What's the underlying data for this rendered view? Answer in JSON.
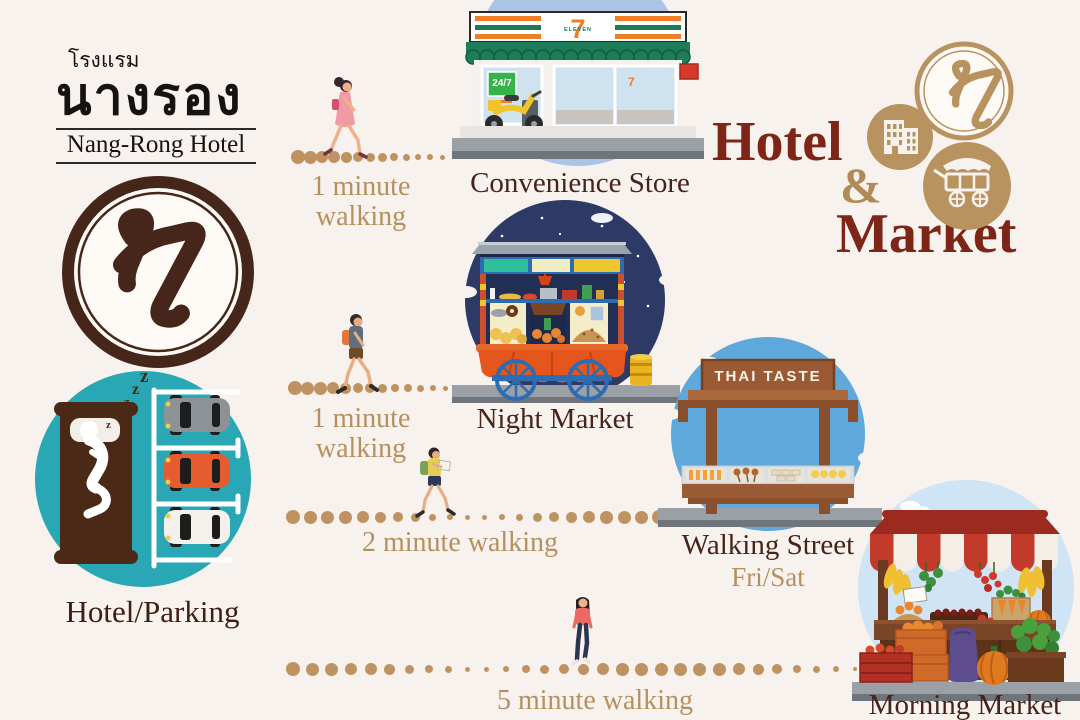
{
  "brand": {
    "thai_line": "โรงแรม",
    "thai_name": "นางรอง",
    "english_name": "Nang-Rong Hotel",
    "monogram": "ห"
  },
  "title": {
    "word1": "Hotel",
    "ampersand": "&",
    "word2": "Market"
  },
  "origin": {
    "label": "Hotel/Parking",
    "sleep_z": "z"
  },
  "routes": [
    {
      "walk_line1": "1 minute",
      "walk_line2": "walking",
      "destination": "Convenience Store"
    },
    {
      "walk_line1": "1 minute",
      "walk_line2": "walking",
      "destination": "Night Market"
    },
    {
      "walk_line1": "2 minute walking",
      "destination": "Walking Street",
      "destination_sub": "Fri/Sat"
    },
    {
      "walk_line1": "5 minute walking",
      "destination": "Morning Market"
    }
  ],
  "signs": {
    "thai_taste": "THAI TASTE",
    "open_hours": "24/7",
    "seven": "7",
    "eleven": "ELEVEN"
  },
  "colors": {
    "background": "#f8f2ee",
    "label_brown": "#46241a",
    "walk_tan": "#b5905e",
    "title_maroon": "#7d2517",
    "badge_tan": "#b9935f",
    "dot_tan": "#bf9361",
    "hotel_teal": "#2aa7b5",
    "store_circle_blue": "#a9c4e4",
    "night_navy": "#2d3a66",
    "street_blue": "#5fa8dc",
    "market_pale_blue": "#cfe4f5",
    "road_gray": "#9aa0a5",
    "wood_brown": "#9a5a34",
    "logo_brown": "#46261a"
  }
}
